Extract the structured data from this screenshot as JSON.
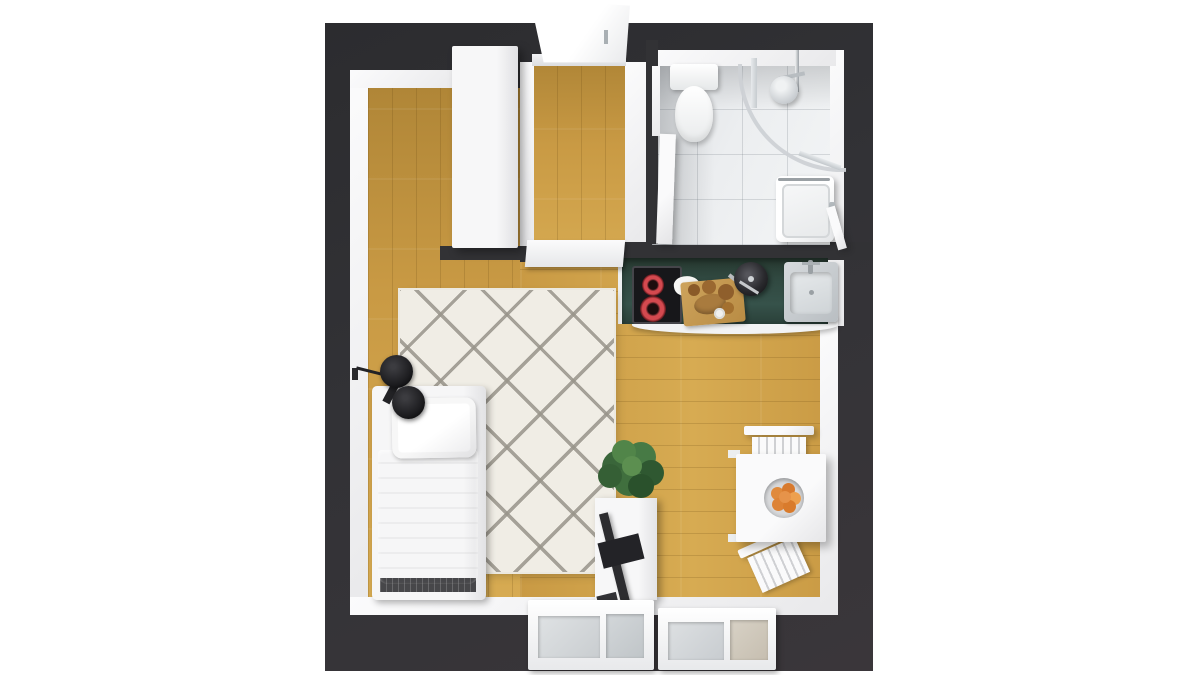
{
  "meta": {
    "title": "3D top-view floor plan render of a studio apartment"
  },
  "palette": {
    "wall": "#323235",
    "wall_inner": "#f3f3f4",
    "wood": "#c99a44",
    "wood_dark": "#b08637",
    "wood_light": "#d7ab52",
    "tile": "#eceef0",
    "counter": "#304840",
    "rug": "#f0ede5",
    "rug_line": "#98948a",
    "duvet": "#d5d5d7",
    "glass": "#d3d7da",
    "plant": "#3d6b3c",
    "orange": "#e0873a",
    "burner": "#d4494f",
    "dark_item": "#2b2b2e",
    "lamp": "#1d1d20"
  },
  "rooms": [
    {
      "id": "living",
      "label": "main living area",
      "floor": "wood"
    },
    {
      "id": "hallway",
      "label": "entry hallway",
      "floor": "wood"
    },
    {
      "id": "bathroom",
      "label": "bathroom",
      "floor": "light tile"
    },
    {
      "id": "kitchen",
      "label": "kitchenette along wall",
      "floor": "wood"
    }
  ],
  "furniture": [
    "entry-door",
    "wardrobe",
    "interior-door",
    "bathroom-door",
    "toilet",
    "corner-shower",
    "shower-head",
    "washing-machine",
    "kitchen-counter",
    "cooktop",
    "cutting-board",
    "cooking-pot",
    "kitchen-sink",
    "area-rug",
    "single-bed",
    "pillow",
    "duvet",
    "wall-lamp",
    "tv-stand",
    "tv",
    "potted-plant",
    "dining-table",
    "fruit-bowl",
    "dining-chair",
    "dining-chair",
    "window",
    "window"
  ]
}
